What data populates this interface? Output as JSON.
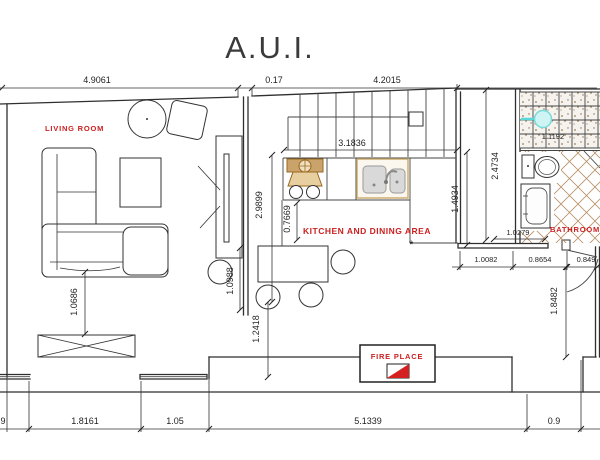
{
  "title": "A.U.I.",
  "room_labels": {
    "living_room": "LIVING ROOM",
    "kitchen_dining": "KITCHEN AND DINING AREA",
    "bathroom": "BATHROOM",
    "fireplace": "FIRE PLACE"
  },
  "symbols": {
    "dining_marker": "*"
  },
  "dimensions": {
    "top_living_width": "4.9061",
    "top_wall_thickness": "0.17",
    "top_right_width": "4.2015",
    "stairs_width": "3.1836",
    "hall_height": "2.9899",
    "counter_offset": "0.7669",
    "partition_lower": "1.0988",
    "passage_height": "1.2418",
    "kitchen_right_height": "1.4934",
    "bathroom_height": "2.4734",
    "shower_width": "1.1192",
    "bathroom_width": "1.0279",
    "below_bath_left": "1.0082",
    "bath_door_width": "0.8654",
    "below_bath_right": "0.849",
    "entry_hall_height": "1.8482",
    "sofa_to_wall": "1.0686",
    "bottom_partial": "9",
    "bottom_window_width": "1.8161",
    "bottom_wall_segment": "1.05",
    "bottom_main_width": "5.1339",
    "bottom_right_width": "0.9"
  },
  "colors": {
    "annotation_red": "#cc2020",
    "line": "#2f2f2f",
    "stove_tan": "#9a6a20",
    "stove_fill": "#e8cf9f",
    "sink_frame": "#c9a96a",
    "basin_gray": "#d9d9d9",
    "tile_line": "#b99066",
    "shower_blue": "#7adada",
    "shower_fill": "#cff4f4"
  }
}
